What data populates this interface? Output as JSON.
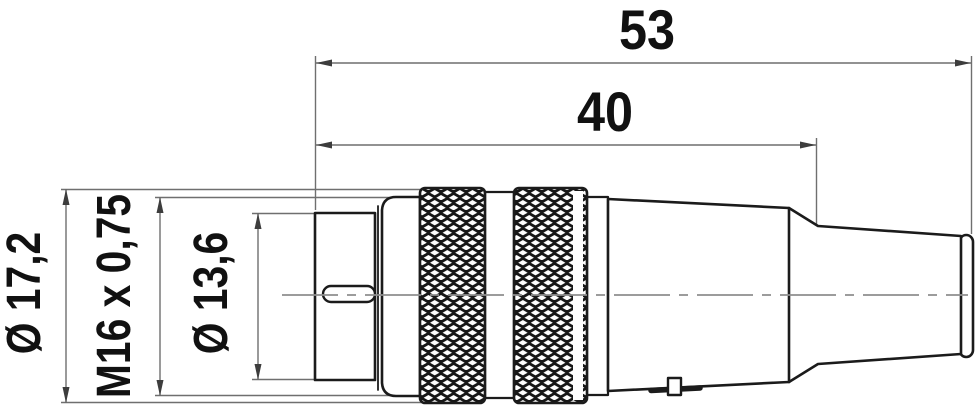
{
  "figure": {
    "type": "technical-drawing",
    "labels": {
      "overall_length": "53",
      "body_length": "40",
      "outer_diameter": "Ø 17,2",
      "thread": "M16 x 0,75",
      "front_diameter": "Ø 13,6"
    },
    "colors": {
      "outline": "#1b1b1b",
      "dimension": "#6f6f6f",
      "arrow": "#3d3d3d",
      "centerline": "#8f8f8f",
      "text": "#111111",
      "background": "#ffffff"
    }
  }
}
